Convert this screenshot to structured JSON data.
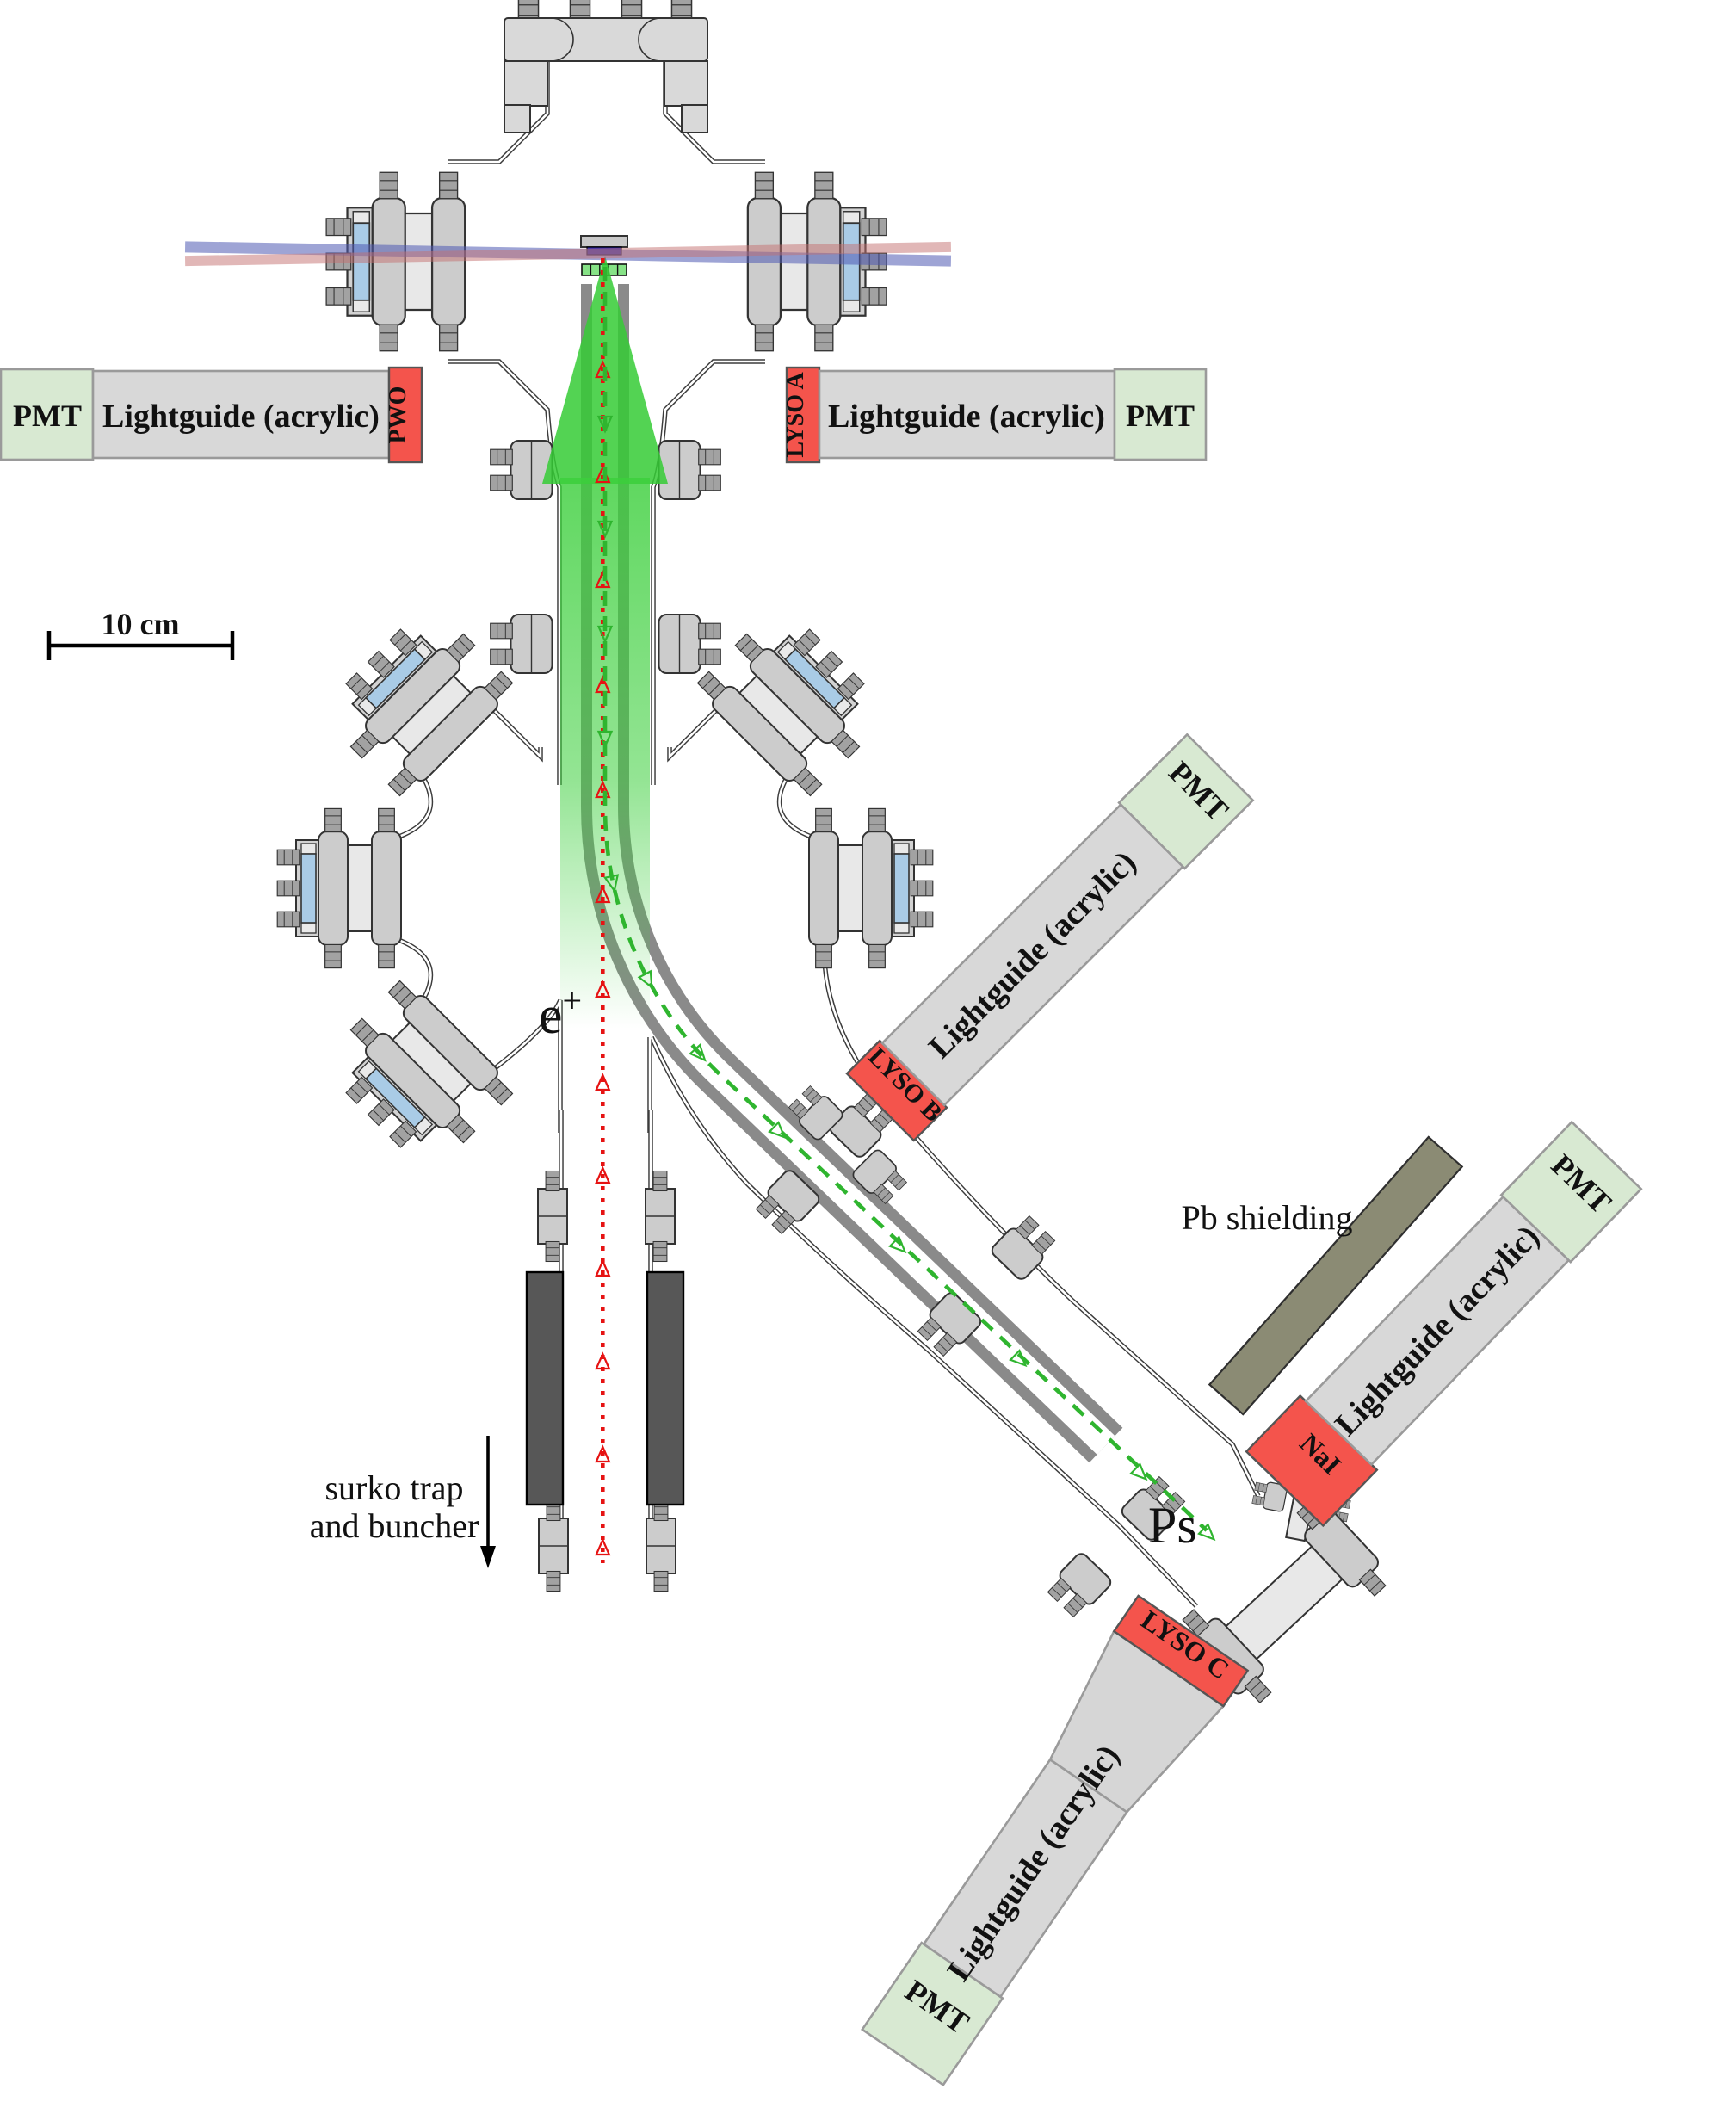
{
  "diagram": {
    "scale_bar": {
      "label": "10 cm"
    },
    "annotations": {
      "positron_label": "e",
      "positron_sup": "+",
      "ps_label": "Ps",
      "trap_label_line1": "surko trap",
      "trap_label_line2": "and buncher",
      "pb_label": "Pb shielding"
    },
    "detectors": {
      "left": {
        "pmt": "PMT",
        "lightguide": "Lightguide (acrylic)",
        "crystal": "PWO"
      },
      "right": {
        "pmt": "PMT",
        "lightguide": "Lightguide (acrylic)",
        "crystal": "LYSO A"
      },
      "b": {
        "pmt": "PMT",
        "lightguide": "Lightguide (acrylic)",
        "crystal": "LYSO B"
      },
      "nai": {
        "pmt": "PMT",
        "lightguide": "Lightguide (acrylic)",
        "crystal": "NaI"
      },
      "c": {
        "pmt": "PMT",
        "lightguide": "Lightguide (acrylic)",
        "crystal": "LYSO C"
      }
    },
    "colors": {
      "pmt_fill": "#d8e9d2",
      "lightguide_fill": "#d8d8d8",
      "crystal_fill": "#f4544c",
      "pb_fill": "#8b8b74",
      "pb_text": "#8f8f78",
      "beam_green": "#3ccf3c",
      "ps_green": "#4db84d",
      "positron_red": "#e61313",
      "laser_blue": "#4e59b2",
      "laser_pink": "#c47070",
      "window_blue": "#a9cbe6"
    }
  }
}
